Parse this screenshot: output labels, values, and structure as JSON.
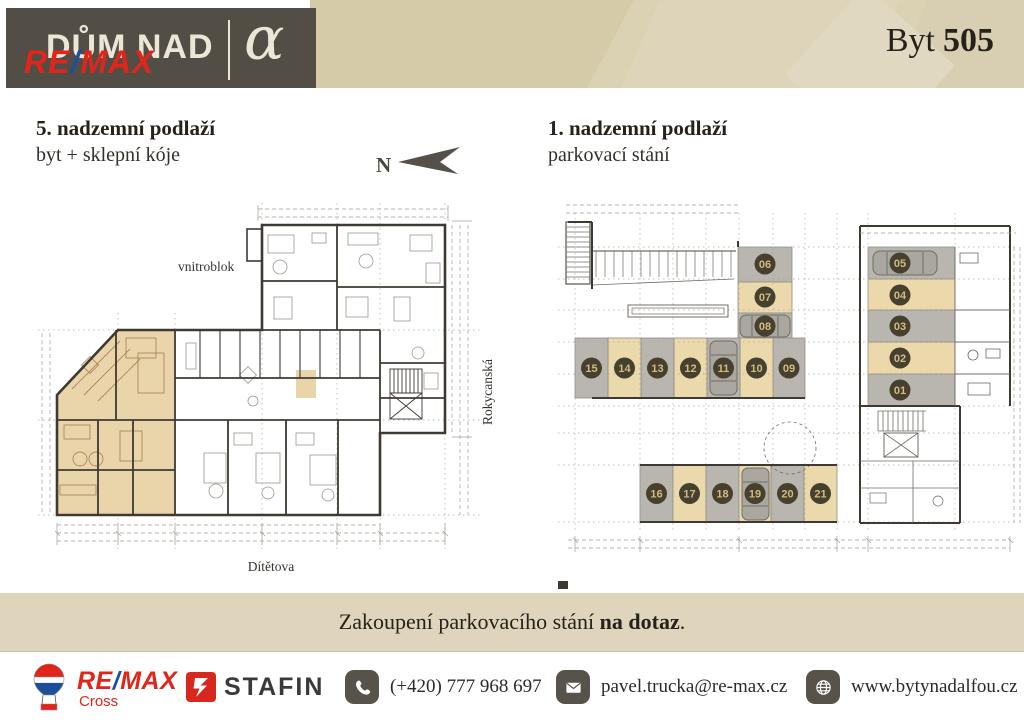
{
  "header": {
    "logo_title": "DŮM NAD",
    "logo_alpha": "α",
    "remax_wordmark": {
      "re": "RE",
      "slash": "/",
      "max": "MAX"
    },
    "apartment_label": "Byt",
    "apartment_number": "505"
  },
  "left_plan": {
    "title": "5. nadzemní podlaží",
    "subtitle": "byt + sklepní kóje",
    "north_label": "N",
    "labels": {
      "courtyard": "vnitroblok",
      "street_right": "Rokycanská",
      "street_bottom": "Dítětova"
    }
  },
  "right_plan": {
    "title": "1. nadzemní podlaží",
    "subtitle": "parkovací stání",
    "spots": [
      {
        "id": "01",
        "shade": "gray"
      },
      {
        "id": "02",
        "shade": "tan"
      },
      {
        "id": "03",
        "shade": "gray"
      },
      {
        "id": "04",
        "shade": "tan"
      },
      {
        "id": "05",
        "shade": "gray"
      },
      {
        "id": "06",
        "shade": "gray"
      },
      {
        "id": "07",
        "shade": "tan"
      },
      {
        "id": "08",
        "shade": "gray"
      },
      {
        "id": "09",
        "shade": "gray"
      },
      {
        "id": "10",
        "shade": "tan"
      },
      {
        "id": "11",
        "shade": "gray"
      },
      {
        "id": "12",
        "shade": "tan"
      },
      {
        "id": "13",
        "shade": "gray"
      },
      {
        "id": "14",
        "shade": "tan"
      },
      {
        "id": "15",
        "shade": "gray"
      },
      {
        "id": "16",
        "shade": "gray"
      },
      {
        "id": "17",
        "shade": "tan"
      },
      {
        "id": "18",
        "shade": "gray"
      },
      {
        "id": "19",
        "shade": "tan"
      },
      {
        "id": "20",
        "shade": "gray"
      },
      {
        "id": "21",
        "shade": "tan"
      }
    ]
  },
  "notice": {
    "prefix": "Zakoupení parkovacího stání ",
    "bold": "na dotaz",
    "suffix": "."
  },
  "footer": {
    "remax": {
      "re": "RE",
      "slash": "/",
      "max": "MAX",
      "sub": "Cross"
    },
    "stafin": "STAFIN",
    "phone": "(+420) 777 968 697",
    "email": "pavel.trucka@re-max.cz",
    "website": "www.bytynadalfou.cz"
  },
  "colors": {
    "dark_header": "#524e46",
    "cream": "#ece6d6",
    "beige_band": "#dbd2b4",
    "notice_bar": "#ded5bc",
    "highlight_tan": "#e7cf9e",
    "spot_tan": "#ecd9ab",
    "spot_gray": "#b9b6af",
    "badge_bg": "#46402f",
    "badge_text": "#d4ba80",
    "remax_red": "#e1251b",
    "remax_blue": "#1b4f9c",
    "stafin_red": "#d6281e",
    "icon_chip": "#57534a"
  }
}
